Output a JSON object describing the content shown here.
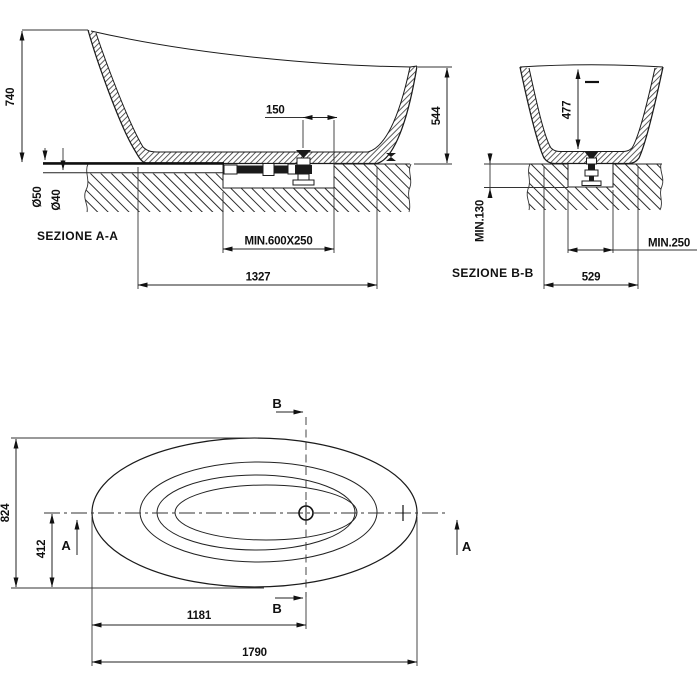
{
  "sections": {
    "aa": {
      "name": "SEZIONE  A-A",
      "dims": {
        "height_back": "740",
        "drain_offset": "150",
        "height_front": "544",
        "pipe_d50": "Ø50",
        "pipe_d40": "Ø40",
        "recess": "MIN.600X250",
        "base_length": "1327"
      }
    },
    "bb": {
      "name": "SEZIONE  B-B",
      "dims": {
        "inner_depth": "477",
        "recess_depth": "MIN.130",
        "recess_width": "MIN.250",
        "base_width": "529"
      }
    },
    "plan": {
      "dims": {
        "overall_width": "824",
        "center_offset": "412",
        "drain_position": "1181",
        "overall_length": "1790"
      },
      "cut_a": "A",
      "cut_b": "B"
    }
  }
}
